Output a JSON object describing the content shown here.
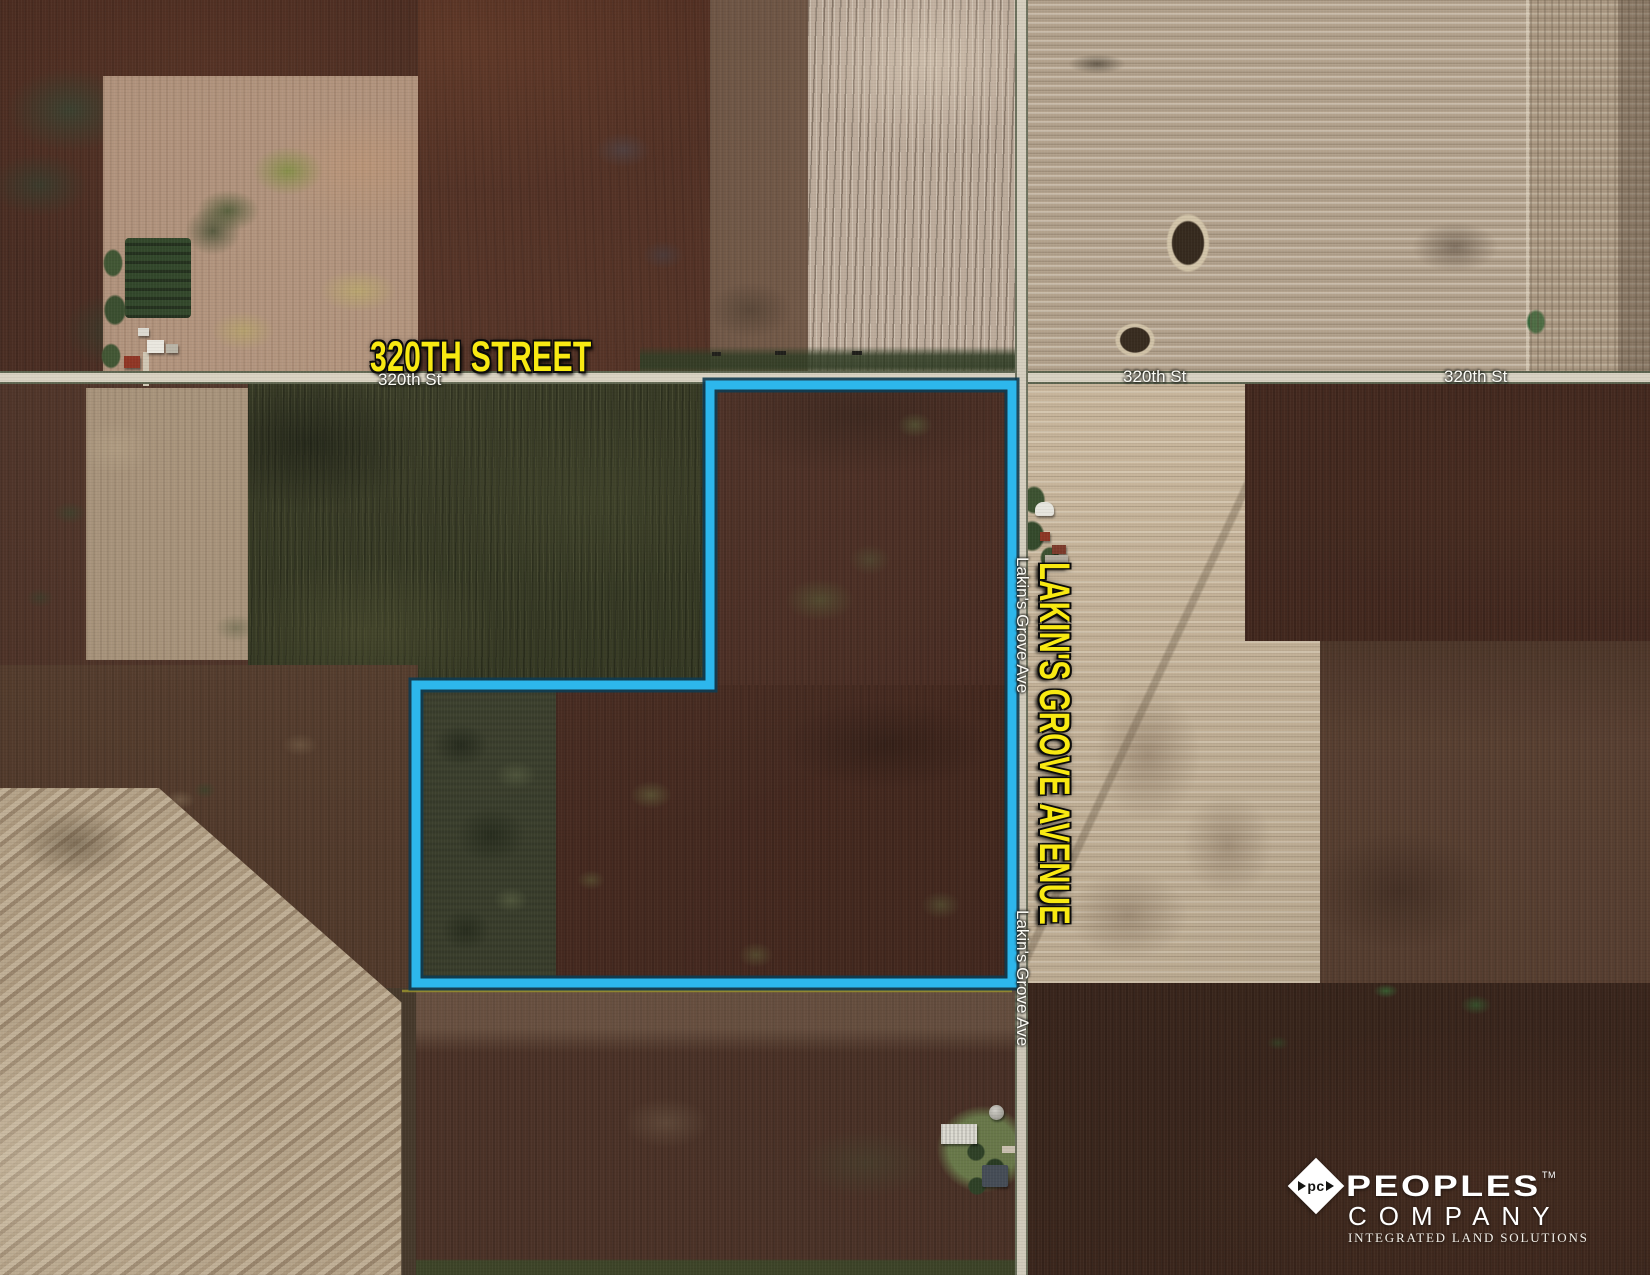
{
  "map": {
    "street_label": "320TH STREET",
    "avenue_label": "LAKIN'S GROVE AVENUE",
    "road_label_street": "320th St",
    "road_label_avenue": "Lakin's Grove Ave",
    "boundary_color": "#2db7ec",
    "highlight_label_color": "#f8e912",
    "road_label_color": "#fbfbf5"
  },
  "logo": {
    "monogram": "pc",
    "name": "PEOPLES",
    "trademark": "TM",
    "subname": "COMPANY",
    "tagline": "INTEGRATED LAND SOLUTIONS"
  }
}
